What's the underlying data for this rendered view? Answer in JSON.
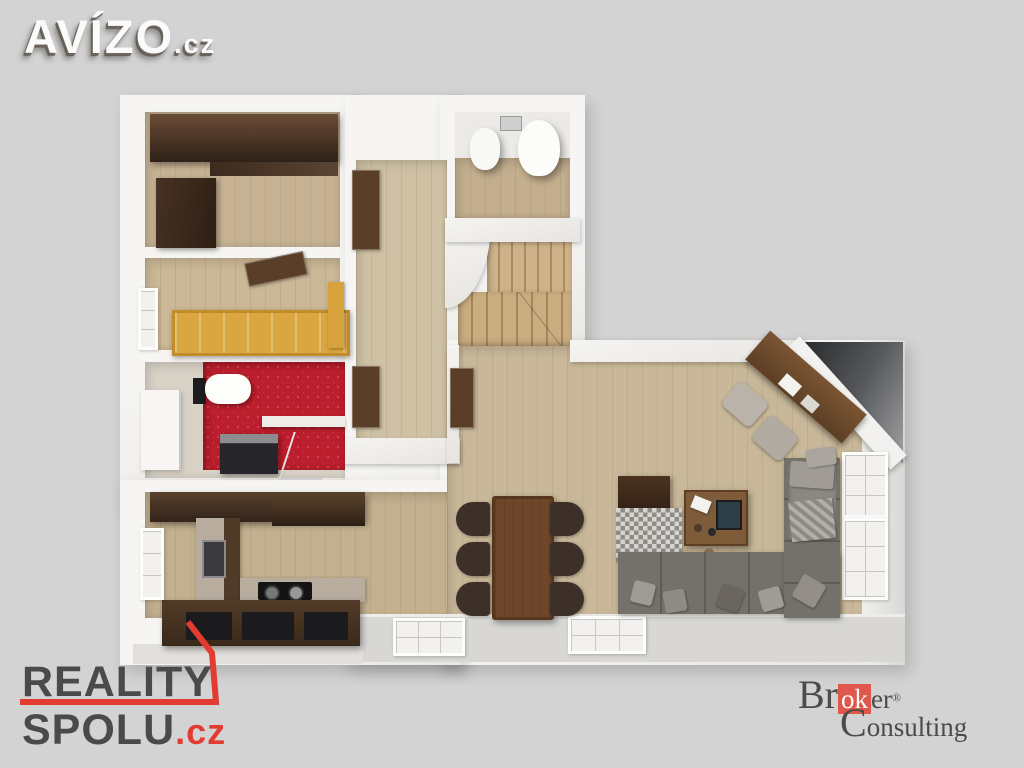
{
  "canvas": {
    "width": 1024,
    "height": 768,
    "background": "#d3d3d3"
  },
  "watermarks": {
    "avizo": {
      "name": "AVÍZO",
      "tld": ".cz",
      "text_color": "#fbfbfb"
    },
    "reality_spolu": {
      "line1": "REALITY",
      "line2": "SPOLU",
      "tld": ".cz",
      "text_color": "#4b4a48",
      "accent_color": "#e23b32"
    },
    "broker": {
      "pre": "Br",
      "highlight": "ok",
      "post": "er",
      "registered": "®",
      "line2": "Consulting",
      "text_color": "#4c4b49",
      "highlight_bg": "#e0584c"
    }
  },
  "floorplan": {
    "style": "3D top-down architectural render of an apartment",
    "palette": {
      "wall": "#f3f2ef",
      "floor_wood": "#c8b798",
      "dark_wood_furniture": "#503a28",
      "red_bathroom_tile": "#bb1e2c",
      "yellow_bed": "#d9a63f",
      "sofa_gray": "#74706a",
      "stairs_wood": "#c9ad82",
      "corner_shadow": "#3a3c3e"
    },
    "rooms": [
      "bedroom-with-wardrobe",
      "bedroom-with-yellow-bed",
      "bathroom-red-tiles",
      "kitchen",
      "hallway",
      "wc",
      "winding-staircase",
      "living-dining-room"
    ]
  }
}
